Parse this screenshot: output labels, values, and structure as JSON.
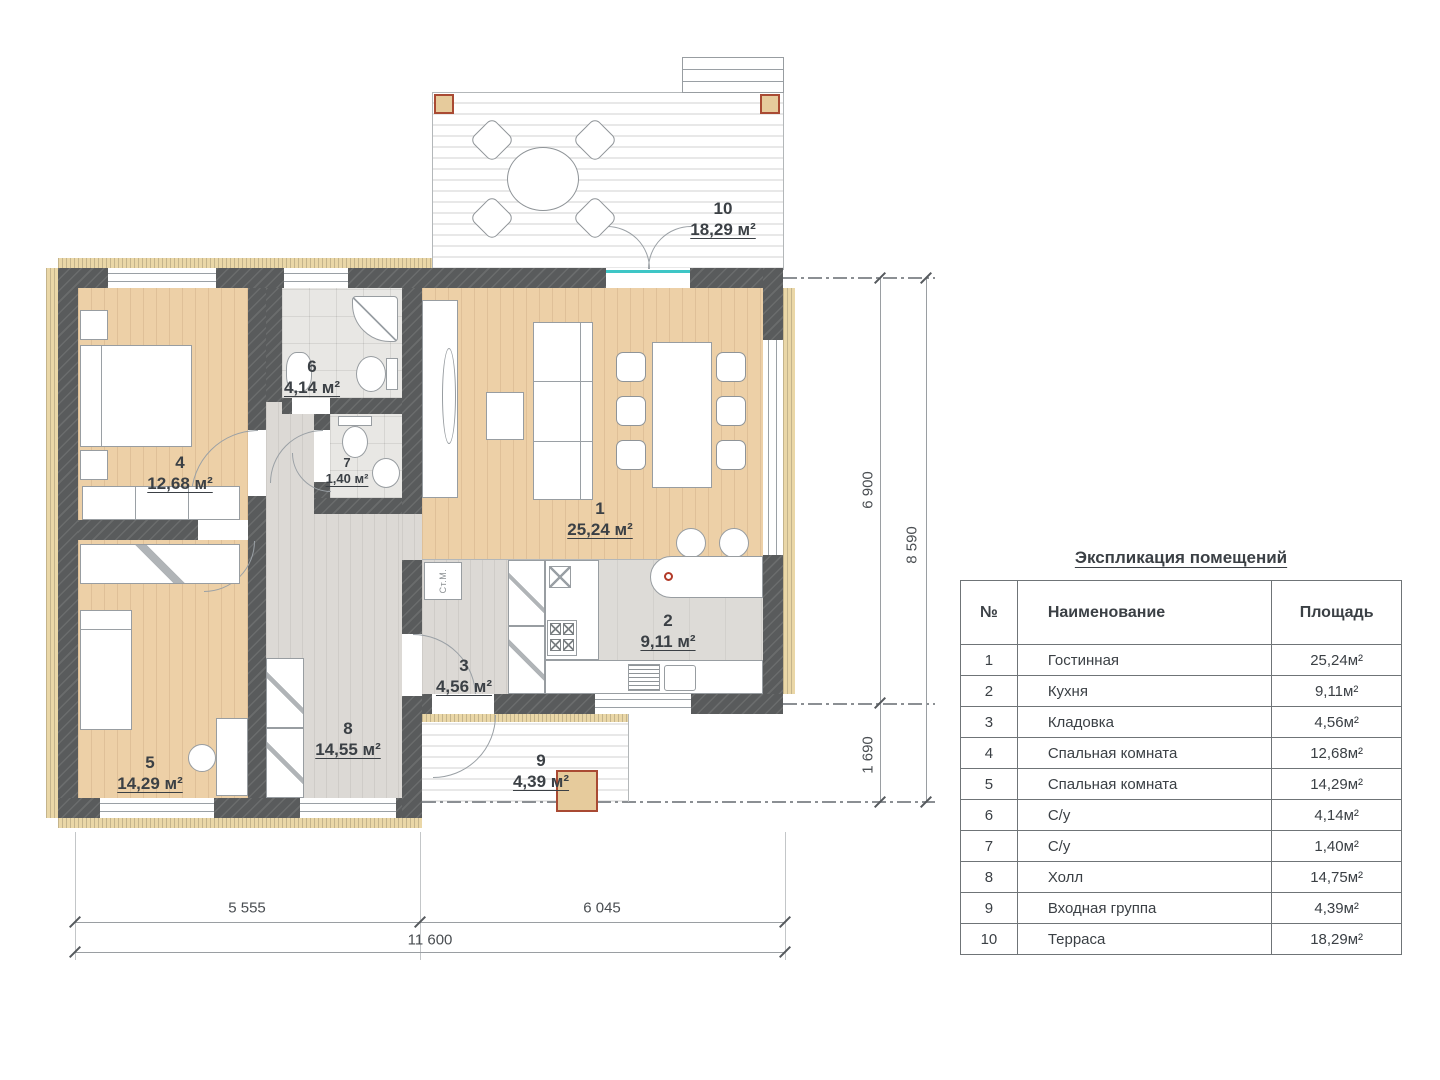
{
  "schedule": {
    "title": "Экспликация помещений",
    "headers": {
      "num": "№",
      "name": "Наименование",
      "area": "Площадь"
    },
    "rows": [
      {
        "num": "1",
        "name": "Гостинная",
        "area": "25,24м²"
      },
      {
        "num": "2",
        "name": "Кухня",
        "area": "9,11м²"
      },
      {
        "num": "3",
        "name": "Кладовка",
        "area": "4,56м²"
      },
      {
        "num": "4",
        "name": "Спальная комната",
        "area": "12,68м²"
      },
      {
        "num": "5",
        "name": "Спальная комната",
        "area": "14,29м²"
      },
      {
        "num": "6",
        "name": "С/у",
        "area": "4,14м²"
      },
      {
        "num": "7",
        "name": "С/у",
        "area": "1,40м²"
      },
      {
        "num": "8",
        "name": "Холл",
        "area": "14,75м²"
      },
      {
        "num": "9",
        "name": "Входная группа",
        "area": "4,39м²"
      },
      {
        "num": "10",
        "name": "Терраса",
        "area": "18,29м²"
      }
    ]
  },
  "plan": {
    "labels": [
      {
        "num": "1",
        "area": "25,24 м²"
      },
      {
        "num": "2",
        "area": "9,11 м²"
      },
      {
        "num": "3",
        "area": "4,56 м²"
      },
      {
        "num": "4",
        "area": "12,68 м²"
      },
      {
        "num": "5",
        "area": "14,29 м²"
      },
      {
        "num": "6",
        "area": "4,14 м²"
      },
      {
        "num": "7",
        "area": "1,40 м²"
      },
      {
        "num": "8",
        "area": "14,55 м²"
      },
      {
        "num": "9",
        "area": "4,39 м²"
      },
      {
        "num": "10",
        "area": "18,29 м²"
      }
    ],
    "washer": "Ст.М.",
    "dims": {
      "w_left": "5 555",
      "w_right": "6 045",
      "w_total": "11 600",
      "h_upper": "6 900",
      "h_total": "8 590",
      "h_lower": "1 690"
    }
  },
  "colors": {
    "wall": "#595b5c",
    "wood_floor": "#edd0a7",
    "hall_floor": "#dcd9d5",
    "insulation": "#ead7a7",
    "accent_red": "#a94a33",
    "threshold_teal": "#3ec6c6"
  }
}
